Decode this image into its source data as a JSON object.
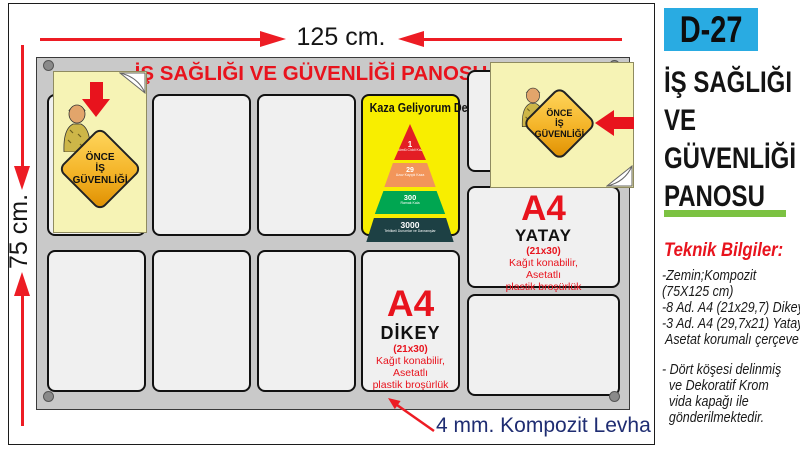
{
  "annotations": {
    "width_label": "125 cm.",
    "height_label": "75 cm.",
    "material_label": "4 mm. Kompozit Levha"
  },
  "board": {
    "title": "İŞ SAĞLIĞI VE GÜVENLİĞİ PANOSU",
    "safety_sign": {
      "line1": "ÖNCE",
      "line2": "İŞ",
      "line3": "GÜVENLİĞİ"
    },
    "poster": {
      "title": "Kaza Geliyorum Der!",
      "pyramid": [
        {
          "value": "1",
          "label": "Ölümlü Ciddi Kaza",
          "color": "#e31e24"
        },
        {
          "value": "29",
          "label": "Uzuv Kayıplı Kaza",
          "color": "#f2955a"
        },
        {
          "value": "300",
          "label": "Ramak Kala",
          "color": "#00a651"
        },
        {
          "value": "3000",
          "label": "Tehlikeli Durumlar ve Davranışlar",
          "color": "#1d4044"
        }
      ]
    },
    "a4_dikey": {
      "code": "A4",
      "orientation": "DİKEY",
      "size": "(21x30)",
      "line1": "Kağıt konabilir,",
      "line2": "Asetatlı",
      "line3": "plastik broşürlük"
    },
    "a4_yatay": {
      "code": "A4",
      "orientation": "YATAY",
      "size": "(21x30)",
      "line1": "Kağıt konabilir,",
      "line2": "Asetatlı",
      "line3": "plastik broşürlük"
    }
  },
  "sidebar": {
    "product_code": "D-27",
    "title_lines": [
      "İŞ SAĞLIĞI",
      "VE",
      "GÜVENLİĞİ",
      "PANOSU"
    ],
    "tech_title": "Teknik Bilgiler:",
    "tech_lines": [
      "-Zemin;Kompozit",
      "(75X125 cm)",
      "-8 Ad. A4 (21x29,7) Dikey",
      "-3 Ad. A4 (29,7x21) Yatay",
      " Asetat korumalı çerçeve",
      "",
      "- Dört köşesi delinmiş",
      "  ve Dekoratif Krom",
      "  vida kapağı ile",
      "  gönderilmektedir."
    ]
  },
  "colors": {
    "accent_red": "#e8131d",
    "dimension_red": "#ed1c24",
    "product_code_bg": "#29abe2",
    "underline_green": "#7cc242",
    "material_text_blue": "#1f2d72",
    "poster_yellow": "#f8ee00",
    "sticker_yellow": "#f6f3b5",
    "board_gray": "#c9c9c9"
  }
}
